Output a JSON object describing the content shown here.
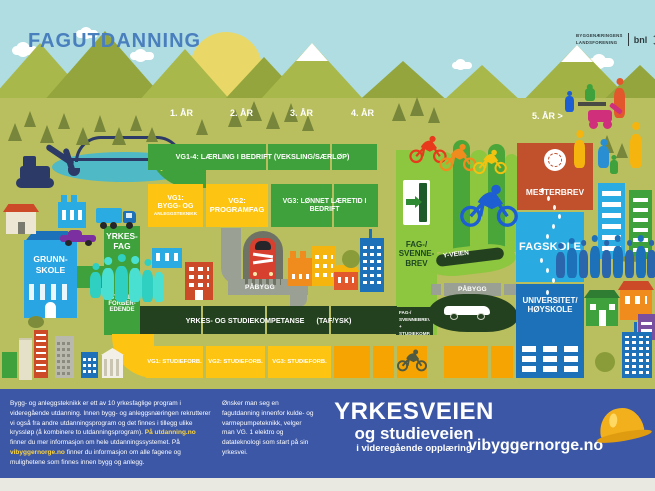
{
  "header": {
    "title": "FAGUTDANNING",
    "logo": {
      "l1": "BYGGENÆRINGENS",
      "l2": "LANDSFORENING",
      "brand": "bnl"
    }
  },
  "years": [
    "1. ÅR",
    "2. ÅR",
    "3. ÅR",
    "4. ÅR",
    "5. ÅR >"
  ],
  "flow": {
    "vg14": "VG1-4: LÆRLING I BEDRIFT (VEKSLING/SÆRLØP)",
    "vg1": {
      "l1": "VG1:",
      "l2": "BYGG- OG",
      "l3": "ANLEGGSTEKNIKK"
    },
    "vg2": {
      "l1": "VG2:",
      "l2": "PROGRAMFAG"
    },
    "vg3": "VG3: LØNNET LÆRETID I BEDRIFT",
    "mesterbrev": "MESTERBREV",
    "fagskole": "FAGSKOLE",
    "universitet": {
      "l1": "UNIVERSITET/",
      "l2": "HØYSKOLE"
    },
    "fagbrev": {
      "l1": "FAG-/",
      "l2": "SVENNE-",
      "l3": "BREV"
    },
    "fagbrev_komp": {
      "l1": "FAG-/",
      "l2": "SVENNEBREV +",
      "l3": "STUDIEKOMP."
    },
    "grunnskole": {
      "l1": "GRUNN-",
      "l2": "SKOLE"
    },
    "yrkesfag": {
      "l1": "YRKES-",
      "l2": "FAG"
    },
    "studieforberedende": {
      "l1": "STUDIE-",
      "l2": "FORBER-",
      "l3": "EDENDE"
    },
    "pabygg_left": "PÅBYGG",
    "pabygg_right": "PÅBYGG",
    "yveien": "Y-VEIEN",
    "ysk": {
      "main": "YRKES- OG STUDIEKOMPETANSE",
      "suffix": "(TAF/YSK)"
    },
    "studieforb_row": [
      "VG1: STUDIEFORB.",
      "VG2: STUDIEFORB.",
      "VG3: STUDIEFORB."
    ]
  },
  "footer": {
    "p1": "Bygg- og anleggsteknikk er ett av 10 yrkesfaglige program i videregående utdanning. Innen bygg- og anleggsnæringen rekrutterer vi også fra andre utdanningsprogram og det finnes i tillegg ulike kryssløp (å kombinere to utdanningsprogram). ",
    "link1": "På utdanning.no",
    "p2": " finner du mer informasjon om hele utdanningssystemet. På ",
    "link2": "vibyggernorge.no",
    "p3": " finner du informasjon om alle fagene og mulighetene som finnes innen bygg og anlegg.",
    "middle": "Ønsker man seg en fagutdanning innenfor kulde- og varmepumpeteknikk, velger man VG. 1 elektro og datateknologi som start på sin yrkesvei.",
    "title1": "YRKESVEIEN",
    "title2": "og studieveien",
    "title3": "i videregående opplæring",
    "site": "vibyggernorge.no"
  },
  "colors": {
    "sky": "#afdde2",
    "ground": "#b9bf5e",
    "green": "#3ea13b",
    "light_green": "#8dc63f",
    "dark_green": "#24411f",
    "yellow": "#fdc412",
    "orange": "#f5a402",
    "red_box": "#c1512d",
    "fagskole_blue": "#29abe2",
    "universitet_blue": "#1d71b8",
    "banner_blue": "#3c57a5",
    "teal_people": "#3fd7c8",
    "title_blue": "#4a7fbe",
    "link_yellow": "#ffd63c"
  }
}
